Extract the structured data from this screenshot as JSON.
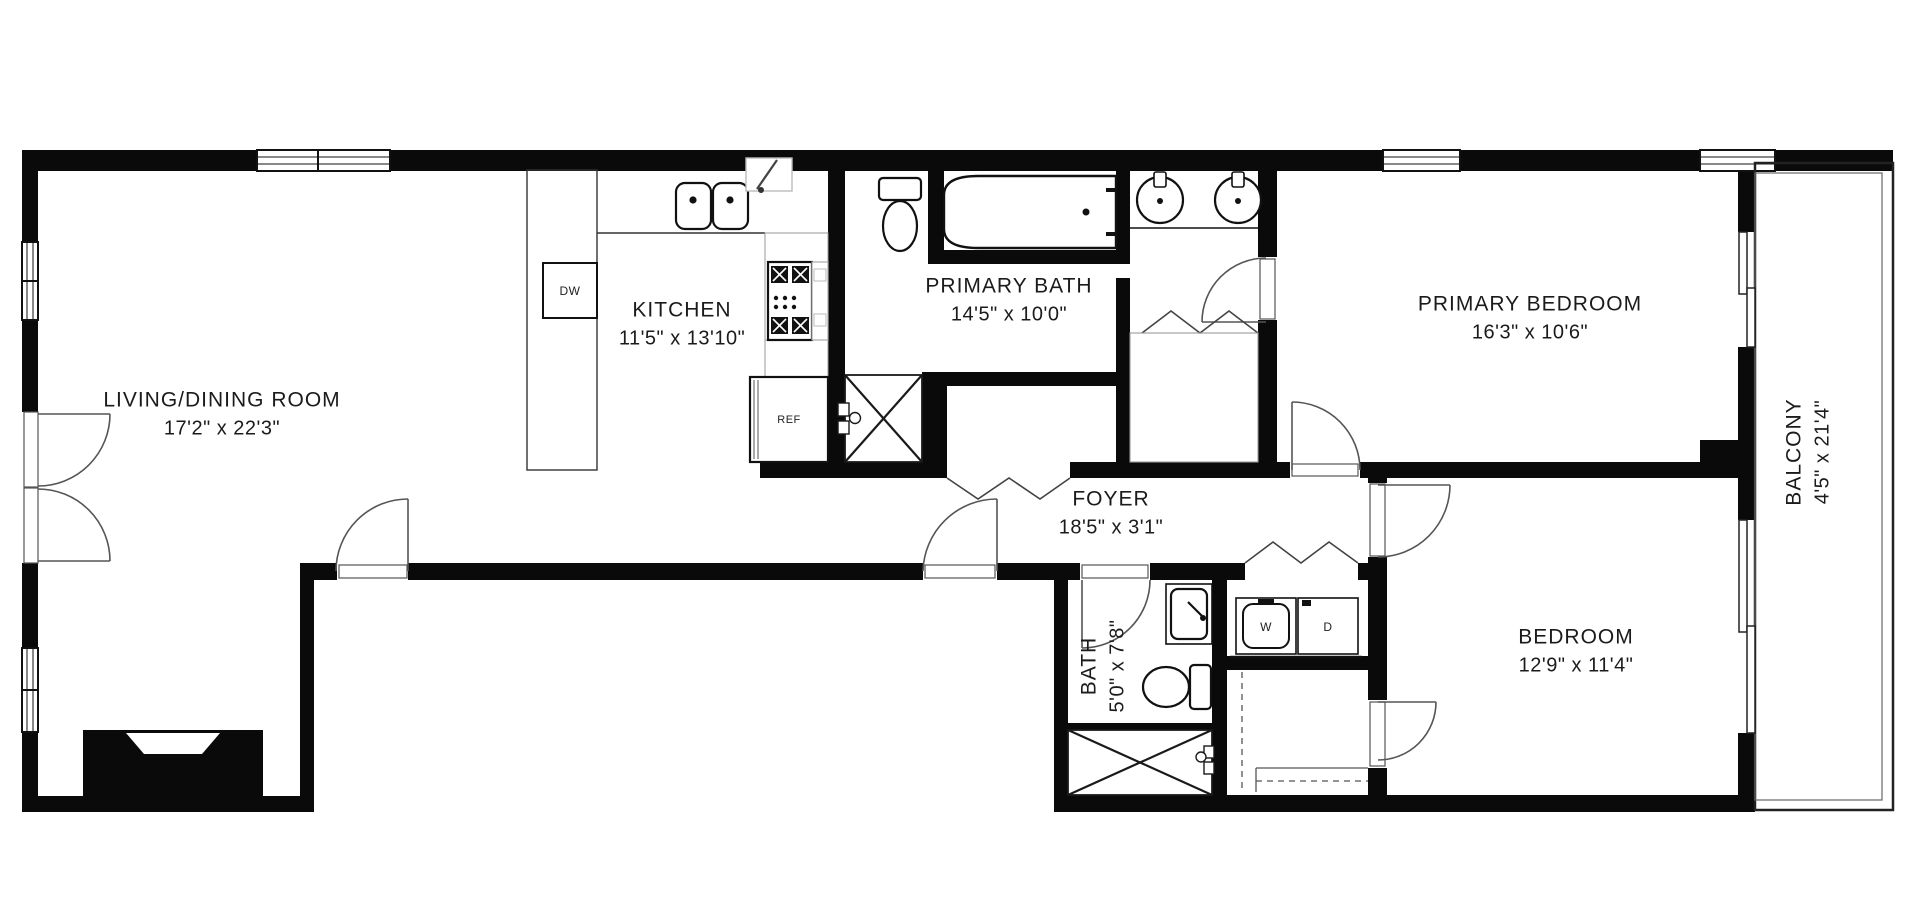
{
  "floor_plan": {
    "title": "Apartment floor plan",
    "rooms": [
      {
        "name": "LIVING/DINING ROOM",
        "dimensions": "17'2\" x 22'3\""
      },
      {
        "name": "KITCHEN",
        "dimensions": "11'5\" x 13'10\""
      },
      {
        "name": "PRIMARY BATH",
        "dimensions": "14'5\" x 10'0\""
      },
      {
        "name": "PRIMARY BEDROOM",
        "dimensions": "16'3\" x 10'6\""
      },
      {
        "name": "FOYER",
        "dimensions": "18'5\" x 3'1\""
      },
      {
        "name": "BATH",
        "dimensions": "5'0\" x 7'8\""
      },
      {
        "name": "BEDROOM",
        "dimensions": "12'9\" x 11'4\""
      },
      {
        "name": "BALCONY",
        "dimensions": "4'5\" x 21'4\""
      }
    ],
    "appliances": {
      "dishwasher": "DW",
      "refrigerator": "REF",
      "washer": "W",
      "dryer": "D"
    },
    "colors": {
      "wall": "#0a0a0a",
      "fixture_line": "#1a1a1a",
      "door_line": "#555555",
      "light_line": "#999999",
      "background": "#ffffff"
    }
  }
}
